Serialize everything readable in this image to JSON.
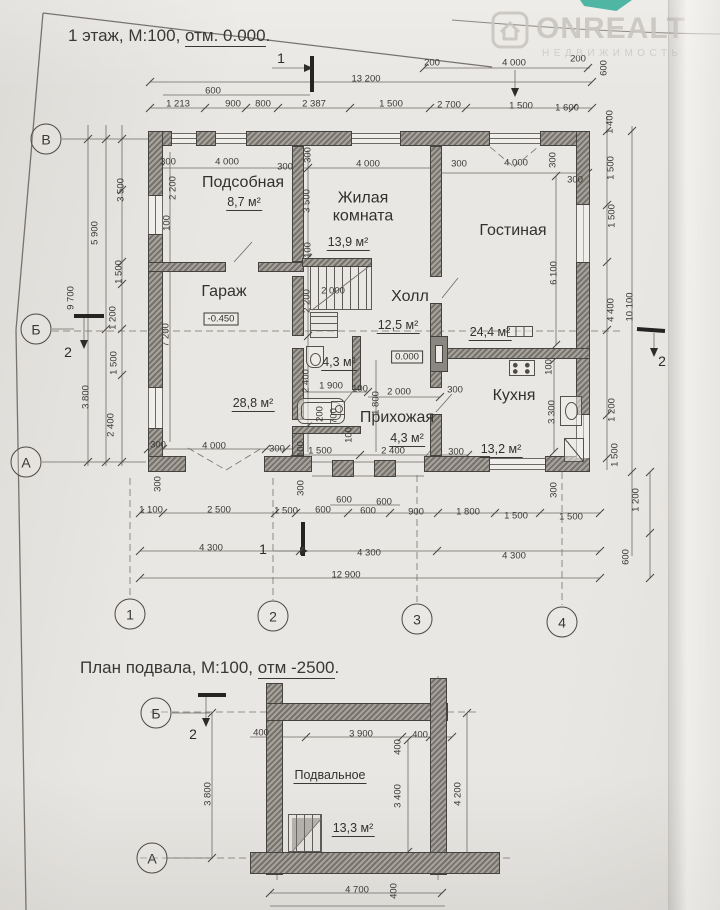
{
  "meta": {
    "title_floor1": {
      "pre": "1 этаж, М:100, ",
      "underlined": "отм. 0.000",
      "post": "."
    },
    "title_basement": {
      "pre": "План подвала, М:100, ",
      "underlined": "отм -2500",
      "post": "."
    },
    "watermark": {
      "brand": "ONREALT",
      "subtitle": "НЕДВИЖИМОСТЬ"
    },
    "corner_color": "#4fb6a4"
  },
  "floor1": {
    "rooms": [
      {
        "t": "Подсобная",
        "x": 243,
        "y": 183
      },
      {
        "t": "Жилая комната",
        "x": 363,
        "y": 207,
        "w": 98
      },
      {
        "t": "Гостиная",
        "x": 513,
        "y": 231
      },
      {
        "t": "Гараж",
        "x": 224,
        "y": 292
      },
      {
        "t": "Холл",
        "x": 410,
        "y": 297
      },
      {
        "t": "Кухня",
        "x": 514,
        "y": 396
      },
      {
        "t": "Прихожая",
        "x": 397,
        "y": 418
      }
    ],
    "areas": [
      {
        "t": "8,7 м²",
        "x": 244,
        "y": 203
      },
      {
        "t": "13,9 м²",
        "x": 348,
        "y": 243
      },
      {
        "t": "24,4 м²",
        "x": 490,
        "y": 333
      },
      {
        "t": "28,8 м²",
        "x": 253,
        "y": 404
      },
      {
        "t": "12,5 м²",
        "x": 398,
        "y": 326
      },
      {
        "t": "13,2 м²",
        "x": 501,
        "y": 450
      },
      {
        "t": "4,3 м²",
        "x": 407,
        "y": 439
      },
      {
        "t": "4,3 м²",
        "x": 339,
        "y": 363
      }
    ],
    "elevations": [
      {
        "t": "-0.450",
        "x": 221,
        "y": 319
      },
      {
        "t": "0.000",
        "x": 407,
        "y": 357
      }
    ],
    "axes": [
      {
        "t": "В",
        "x": 46,
        "y": 139
      },
      {
        "t": "Б",
        "x": 36,
        "y": 329
      },
      {
        "t": "А",
        "x": 26,
        "y": 462
      }
    ],
    "columns": [
      {
        "t": "1",
        "x": 130,
        "y": 614
      },
      {
        "t": "2",
        "x": 273,
        "y": 616
      },
      {
        "t": "3",
        "x": 417,
        "y": 619
      },
      {
        "t": "4",
        "x": 562,
        "y": 622
      }
    ],
    "sections": [
      {
        "t": "1",
        "x": 281,
        "y": 58
      },
      {
        "t": "1",
        "x": 263,
        "y": 549
      },
      {
        "t": "2",
        "x": 68,
        "y": 352
      },
      {
        "t": "2",
        "x": 662,
        "y": 361
      }
    ],
    "dims": [
      {
        "t": "200",
        "x": 432,
        "y": 63
      },
      {
        "t": "4 000",
        "x": 514,
        "y": 63
      },
      {
        "t": "200",
        "x": 578,
        "y": 59
      },
      {
        "t": "600",
        "x": 604,
        "y": 68,
        "r": 1
      },
      {
        "t": "13 200",
        "x": 366,
        "y": 79
      },
      {
        "t": "600",
        "x": 213,
        "y": 91
      },
      {
        "t": "1 213",
        "x": 178,
        "y": 104
      },
      {
        "t": "900",
        "x": 233,
        "y": 104
      },
      {
        "t": "800",
        "x": 263,
        "y": 104
      },
      {
        "t": "2 387",
        "x": 314,
        "y": 104
      },
      {
        "t": "1 500",
        "x": 391,
        "y": 104
      },
      {
        "t": "2 700",
        "x": 449,
        "y": 105
      },
      {
        "t": "1 500",
        "x": 521,
        "y": 106
      },
      {
        "t": "1 600",
        "x": 567,
        "y": 108
      },
      {
        "t": "1 400",
        "x": 610,
        "y": 122,
        "r": 1
      },
      {
        "t": "300",
        "x": 168,
        "y": 162
      },
      {
        "t": "4 000",
        "x": 227,
        "y": 162
      },
      {
        "t": "300",
        "x": 285,
        "y": 167
      },
      {
        "t": "300",
        "x": 308,
        "y": 155,
        "r": 1
      },
      {
        "t": "4 000",
        "x": 368,
        "y": 164
      },
      {
        "t": "300",
        "x": 459,
        "y": 164
      },
      {
        "t": "4 000",
        "x": 516,
        "y": 163
      },
      {
        "t": "300",
        "x": 553,
        "y": 160,
        "r": 1
      },
      {
        "t": "300",
        "x": 575,
        "y": 180
      },
      {
        "t": "2 200",
        "x": 173,
        "y": 188,
        "r": 1
      },
      {
        "t": "100",
        "x": 167,
        "y": 223,
        "r": 1
      },
      {
        "t": "7 200",
        "x": 166,
        "y": 335,
        "r": 1
      },
      {
        "t": "3 500",
        "x": 121,
        "y": 190,
        "r": 1
      },
      {
        "t": "5 900",
        "x": 95,
        "y": 233,
        "r": 1
      },
      {
        "t": "9 700",
        "x": 71,
        "y": 298,
        "r": 1
      },
      {
        "t": "1 500",
        "x": 119,
        "y": 272,
        "r": 1
      },
      {
        "t": "1 200",
        "x": 113,
        "y": 318,
        "r": 1
      },
      {
        "t": "1 500",
        "x": 114,
        "y": 363,
        "r": 1
      },
      {
        "t": "3 800",
        "x": 86,
        "y": 397,
        "r": 1
      },
      {
        "t": "2 400",
        "x": 111,
        "y": 425,
        "r": 1
      },
      {
        "t": "1 500",
        "x": 611,
        "y": 168,
        "r": 1
      },
      {
        "t": "1 500",
        "x": 612,
        "y": 216,
        "r": 1
      },
      {
        "t": "4 400",
        "x": 611,
        "y": 310,
        "r": 1
      },
      {
        "t": "10 100",
        "x": 630,
        "y": 307,
        "r": 1
      },
      {
        "t": "1 200",
        "x": 612,
        "y": 410,
        "r": 1
      },
      {
        "t": "1 500",
        "x": 615,
        "y": 455,
        "r": 1
      },
      {
        "t": "1 200",
        "x": 636,
        "y": 500,
        "r": 1
      },
      {
        "t": "600",
        "x": 626,
        "y": 557,
        "r": 1
      },
      {
        "t": "3 500",
        "x": 307,
        "y": 201,
        "r": 1
      },
      {
        "t": "100",
        "x": 308,
        "y": 250,
        "r": 1
      },
      {
        "t": "2 000",
        "x": 333,
        "y": 291
      },
      {
        "t": "2 200",
        "x": 307,
        "y": 301,
        "r": 1
      },
      {
        "t": "6 100",
        "x": 554,
        "y": 273,
        "r": 1
      },
      {
        "t": "100",
        "x": 549,
        "y": 367,
        "r": 1
      },
      {
        "t": "3 300",
        "x": 552,
        "y": 412,
        "r": 1
      },
      {
        "t": "2 400",
        "x": 306,
        "y": 381,
        "r": 1
      },
      {
        "t": "1 900",
        "x": 331,
        "y": 386
      },
      {
        "t": "100",
        "x": 360,
        "y": 389
      },
      {
        "t": "2 000",
        "x": 399,
        "y": 392
      },
      {
        "t": "300",
        "x": 455,
        "y": 390
      },
      {
        "t": "200",
        "x": 320,
        "y": 414,
        "r": 1
      },
      {
        "t": "700",
        "x": 334,
        "y": 416,
        "r": 1
      },
      {
        "t": "1 800",
        "x": 376,
        "y": 403,
        "r": 1
      },
      {
        "t": "100",
        "x": 349,
        "y": 435,
        "r": 1
      },
      {
        "t": "300",
        "x": 158,
        "y": 445
      },
      {
        "t": "4 000",
        "x": 214,
        "y": 446
      },
      {
        "t": "300",
        "x": 277,
        "y": 449
      },
      {
        "t": "100",
        "x": 301,
        "y": 449,
        "r": 1
      },
      {
        "t": "1 500",
        "x": 320,
        "y": 451
      },
      {
        "t": "2 400",
        "x": 393,
        "y": 451
      },
      {
        "t": "300",
        "x": 456,
        "y": 452
      },
      {
        "t": "300",
        "x": 158,
        "y": 484,
        "r": 1
      },
      {
        "t": "300",
        "x": 301,
        "y": 488,
        "r": 1
      },
      {
        "t": "300",
        "x": 554,
        "y": 490,
        "r": 1
      },
      {
        "t": "600",
        "x": 344,
        "y": 500
      },
      {
        "t": "600",
        "x": 384,
        "y": 502
      },
      {
        "t": "1 100",
        "x": 151,
        "y": 510
      },
      {
        "t": "2 500",
        "x": 219,
        "y": 510
      },
      {
        "t": "1 500",
        "x": 286,
        "y": 511
      },
      {
        "t": "600",
        "x": 323,
        "y": 510
      },
      {
        "t": "600",
        "x": 368,
        "y": 511
      },
      {
        "t": "900",
        "x": 416,
        "y": 512
      },
      {
        "t": "1 800",
        "x": 468,
        "y": 512
      },
      {
        "t": "1 500",
        "x": 516,
        "y": 516
      },
      {
        "t": "1 500",
        "x": 571,
        "y": 517
      },
      {
        "t": "4 300",
        "x": 211,
        "y": 548
      },
      {
        "t": "4 300",
        "x": 369,
        "y": 553
      },
      {
        "t": "4 300",
        "x": 514,
        "y": 556
      },
      {
        "t": "12 900",
        "x": 346,
        "y": 575
      }
    ]
  },
  "basement": {
    "areas": [
      {
        "t": "Подвальное",
        "x": 330,
        "y": 776
      },
      {
        "t": "13,3 м²",
        "x": 353,
        "y": 829
      }
    ],
    "axes": [
      {
        "t": "Б",
        "x": 156,
        "y": 713
      },
      {
        "t": "А",
        "x": 152,
        "y": 858
      }
    ],
    "sections": [
      {
        "t": "2",
        "x": 193,
        "y": 734
      }
    ],
    "dims": [
      {
        "t": "400",
        "x": 261,
        "y": 733
      },
      {
        "t": "3 900",
        "x": 361,
        "y": 734
      },
      {
        "t": "400",
        "x": 398,
        "y": 747,
        "r": 1
      },
      {
        "t": "400",
        "x": 420,
        "y": 735
      },
      {
        "t": "3 800",
        "x": 208,
        "y": 794,
        "r": 1
      },
      {
        "t": "3 400",
        "x": 398,
        "y": 796,
        "r": 1
      },
      {
        "t": "4 200",
        "x": 458,
        "y": 794,
        "r": 1
      },
      {
        "t": "4 700",
        "x": 357,
        "y": 890
      },
      {
        "t": "400",
        "x": 394,
        "y": 891,
        "r": 1
      }
    ]
  }
}
